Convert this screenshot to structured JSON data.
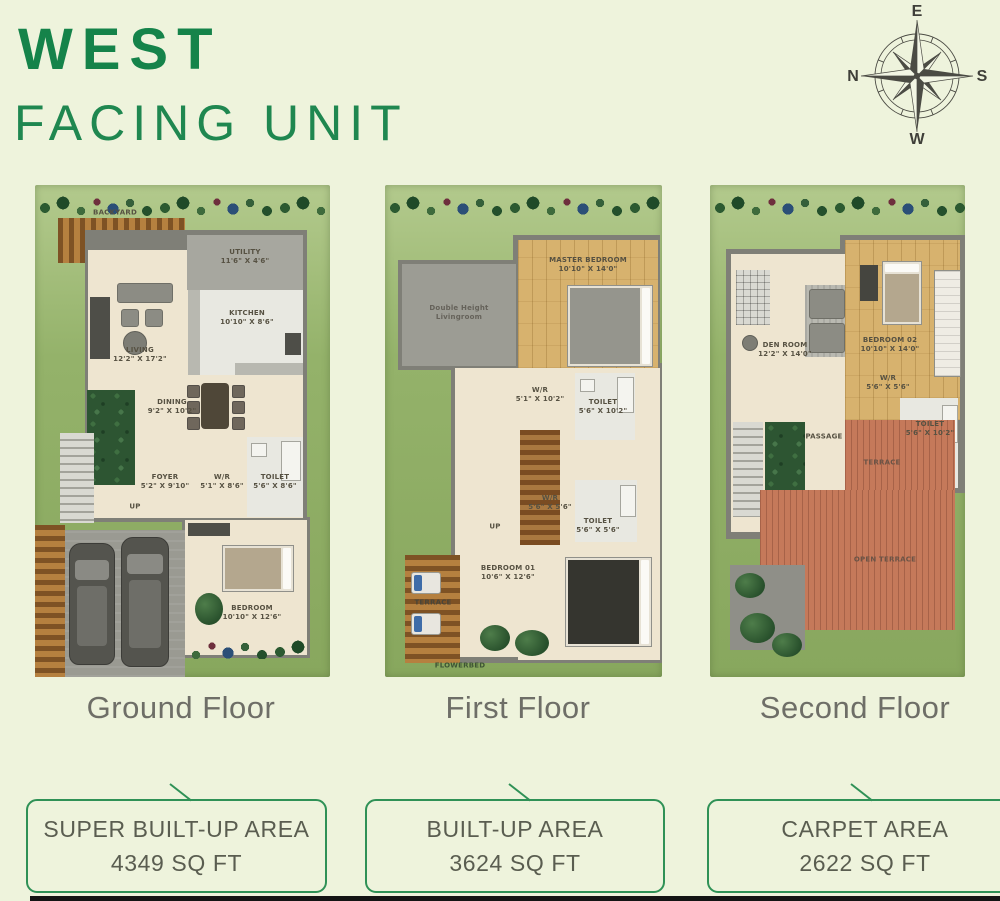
{
  "title": {
    "line1": "WEST",
    "line2": "FACING UNIT"
  },
  "compass": {
    "top": "E",
    "right": "S",
    "bottom": "W",
    "left": "N"
  },
  "floors": [
    {
      "caption": "Ground Floor",
      "yard_label": "BACKYARD",
      "up_label": "UP",
      "rooms": [
        {
          "name": "UTILITY",
          "dims": "11'6\" X 4'6\""
        },
        {
          "name": "KITCHEN",
          "dims": "10'10\" X 8'6\""
        },
        {
          "name": "LIVING",
          "dims": "12'2\" X 17'2\""
        },
        {
          "name": "DINING",
          "dims": "9'2\" X 10'2\""
        },
        {
          "name": "FOYER",
          "dims": "5'2\" X 9'10\""
        },
        {
          "name": "W/R",
          "dims": "5'1\" X 8'6\""
        },
        {
          "name": "TOILET",
          "dims": "5'6\" X 8'6\""
        },
        {
          "name": "BEDROOM",
          "dims": "10'10\" X 12'6\""
        }
      ]
    },
    {
      "caption": "First Floor",
      "up_label": "UP",
      "flowerbed_label": "FLOWERBED",
      "rooms": [
        {
          "name": "MASTER BEDROOM",
          "dims": "10'10\" X 14'0\""
        },
        {
          "name": "Double Height Livingroom",
          "dims": ""
        },
        {
          "name": "W/R",
          "dims": "5'1\" X 10'2\""
        },
        {
          "name": "TOILET",
          "dims": "5'6\" X 10'2\""
        },
        {
          "name": "W/R",
          "dims": "5'6\" X 5'6\""
        },
        {
          "name": "TOILET",
          "dims": "5'6\" X 5'6\""
        },
        {
          "name": "BEDROOM 01",
          "dims": "10'6\" X 12'6\""
        },
        {
          "name": "TERRACE",
          "dims": ""
        }
      ]
    },
    {
      "caption": "Second Floor",
      "rooms": [
        {
          "name": "DEN ROOM",
          "dims": "12'2\" X 14'0\""
        },
        {
          "name": "BEDROOM 02",
          "dims": "10'10\" X 14'0\""
        },
        {
          "name": "W/R",
          "dims": "5'6\" X 5'6\""
        },
        {
          "name": "TOILET",
          "dims": "5'6\" X 10'2\""
        },
        {
          "name": "PASSAGE",
          "dims": ""
        },
        {
          "name": "TERRACE",
          "dims": ""
        },
        {
          "name": "OPEN TERRACE",
          "dims": ""
        }
      ]
    }
  ],
  "area_boxes": [
    {
      "label": "SUPER BUILT-UP AREA",
      "value": "4349 SQ FT"
    },
    {
      "label": "BUILT-UP AREA",
      "value": "3624 SQ FT"
    },
    {
      "label": "CARPET AREA",
      "value": "2622 SQ FT"
    }
  ],
  "colors": {
    "accent_green": "#2f9156",
    "title_green": "#15834a",
    "caption_gray": "#6e6e67"
  }
}
